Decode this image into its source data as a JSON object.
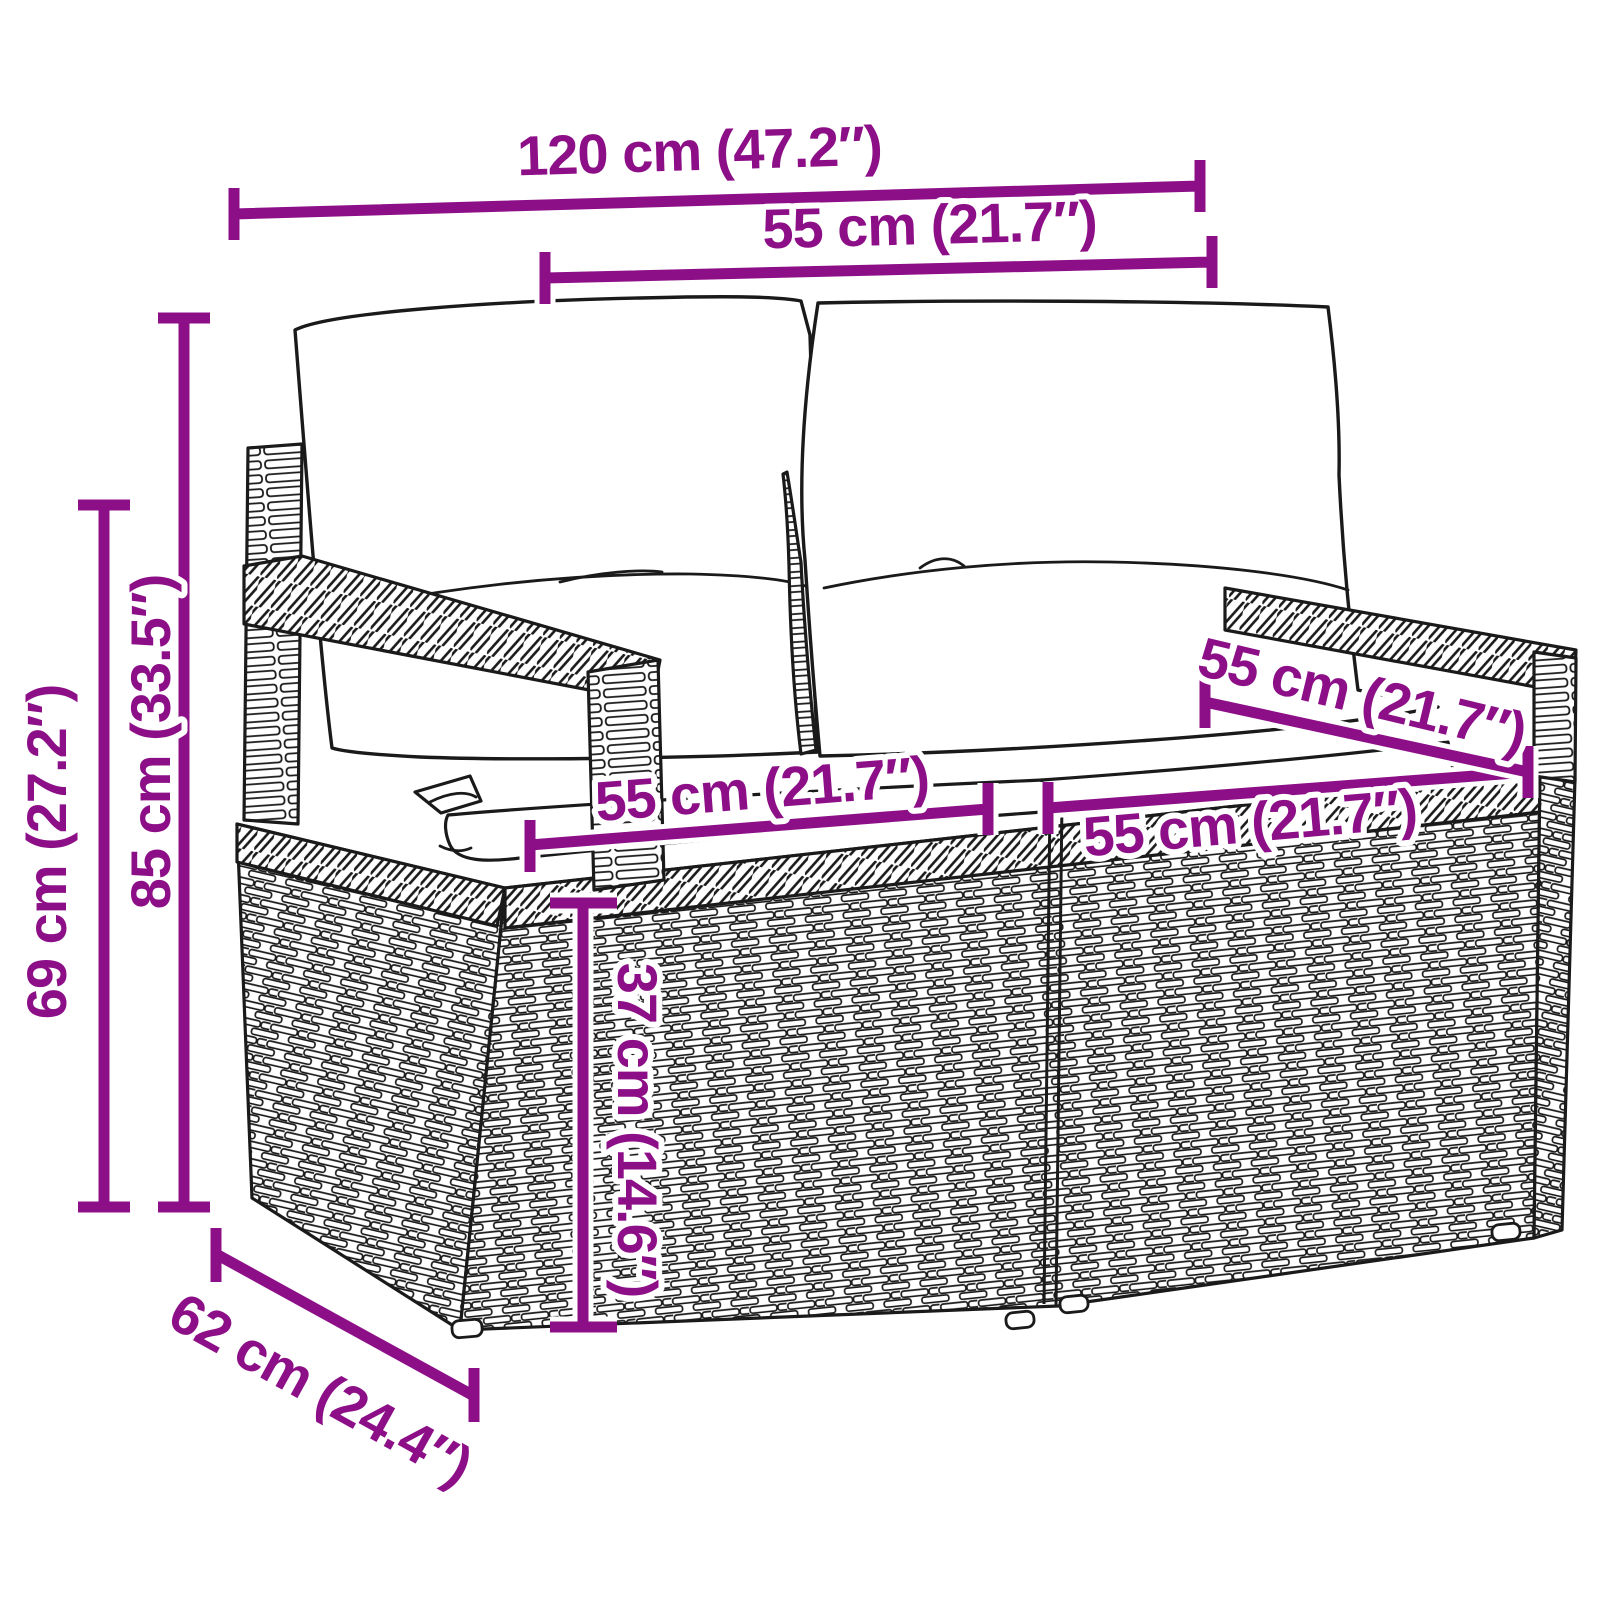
{
  "diagram": {
    "type": "product-dimension-diagram",
    "subject": "2-seater poly rattan garden bench with back and seat cushions",
    "accent_color": "#8D0F88",
    "outline_color": "#1a1a1a",
    "labels": {
      "overall_width": "120 cm (47.2″)",
      "back_cushion_width": "55 cm (21.7″)",
      "total_height": "85 cm (33.5″)",
      "armrest_height": "69 cm (27.2″)",
      "seat_width_left": "55 cm (21.7″)",
      "seat_width_right": "55 cm (21.7″)",
      "seat_depth": "55 cm (21.7″)",
      "seat_height": "37 cm (14.6″)",
      "overall_depth": "62 cm (24.4″)"
    }
  }
}
